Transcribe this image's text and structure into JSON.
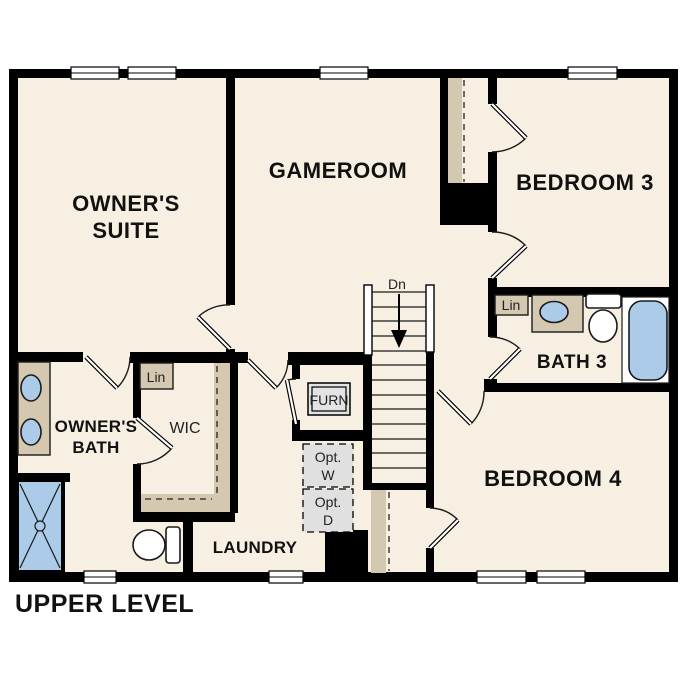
{
  "title": "UPPER LEVEL",
  "colors": {
    "background": "#ffffff",
    "floor": "#f6efe2",
    "wall": "#000000",
    "counter_tan": "#d5c8b0",
    "fixture_blue": "#abcbe9",
    "appliance_gray": "#e3e3e3"
  },
  "rooms": {
    "owners_suite": {
      "line1": "OWNER'S",
      "line2": "SUITE"
    },
    "gameroom": {
      "label": "GAMEROOM"
    },
    "bedroom3": {
      "label": "BEDROOM 3"
    },
    "bath3": {
      "label": "BATH 3"
    },
    "bedroom4": {
      "label": "BEDROOM 4"
    },
    "owners_bath": {
      "line1": "OWNER'S",
      "line2": "BATH"
    },
    "wic": {
      "label": "WIC"
    },
    "laundry": {
      "label": "LAUNDRY"
    }
  },
  "annotations": {
    "stairs_direction": "Dn",
    "linen_wic": "Lin",
    "linen_bath3": "Lin",
    "furnace": "FURN",
    "opt_washer": {
      "line1": "Opt.",
      "line2": "W"
    },
    "opt_dryer": {
      "line1": "Opt.",
      "line2": "D"
    }
  }
}
